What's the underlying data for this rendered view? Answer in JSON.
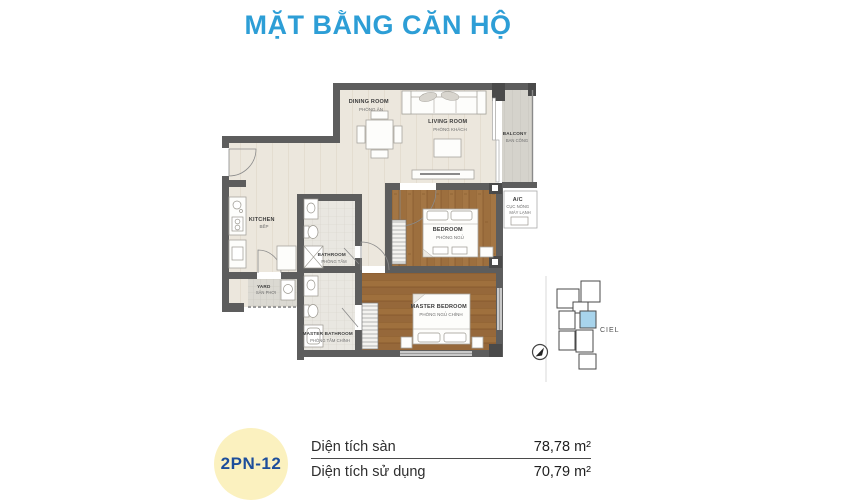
{
  "page_title": "MẶT BẰNG CĂN HỘ",
  "floor_plan": {
    "rooms": [
      {
        "en": "DINING ROOM",
        "vi": "PHÒNG ĂN"
      },
      {
        "en": "LIVING ROOM",
        "vi": "PHÒNG KHÁCH"
      },
      {
        "en": "BALCONY",
        "vi": "BAN CÔNG"
      },
      {
        "en": "KITCHEN",
        "vi": "BẾP"
      },
      {
        "en": "BATHROOM",
        "vi": "PHÒNG TẮM"
      },
      {
        "en": "BEDROOM",
        "vi": "PHÒNG NGỦ"
      },
      {
        "en": "A/C",
        "vi": "CỤC NÓNG",
        "vi2": "MÁY LẠNH"
      },
      {
        "en": "YARD",
        "vi": "SÂN PHƠI"
      },
      {
        "en": "MASTER BATHROOM",
        "vi": "PHÒNG TẮM CHÍNH"
      },
      {
        "en": "MASTER BEDROOM",
        "vi": "PHÒNG NGỦ CHÍNH"
      }
    ],
    "key_map": {
      "project_label": "CIEL"
    }
  },
  "unit_info": {
    "unit_code": "2PN-12",
    "rows": [
      {
        "label": "Diện tích sàn",
        "value": "78,78 m²"
      },
      {
        "label": "Diện tích sử dụng",
        "value": "70,79 m²"
      }
    ]
  },
  "colors": {
    "title_blue": "#2d9ed6",
    "badge_bg": "#fbf1bf",
    "badge_text": "#1d4e9b",
    "unit_highlight": "#a8d4ec",
    "wall_gray": "#5d5d5d",
    "wood_floor": "#9c6f3f",
    "light_floor": "#ece7dd"
  }
}
